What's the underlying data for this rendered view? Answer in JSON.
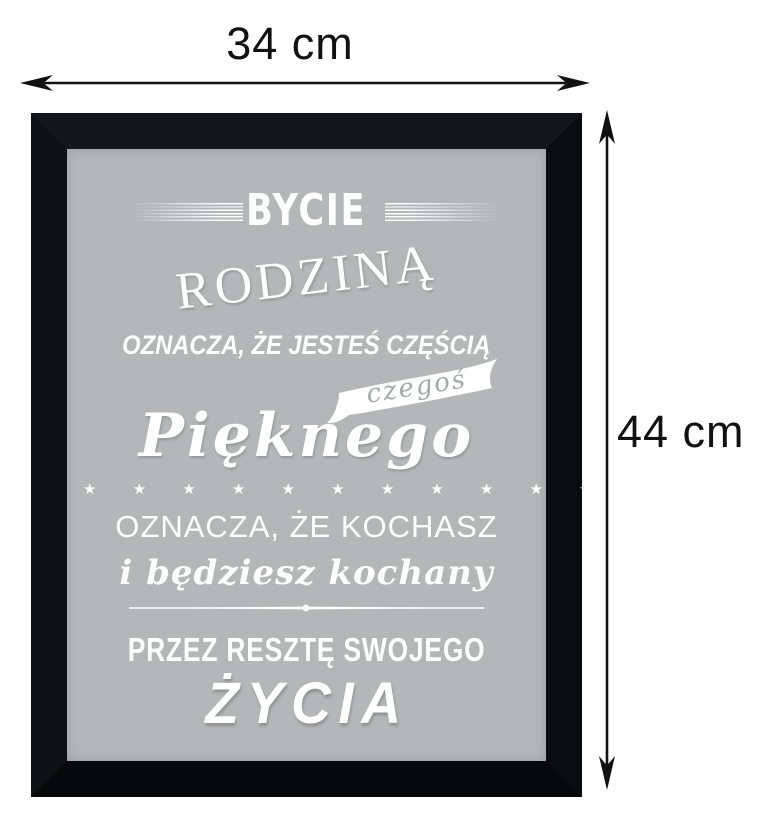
{
  "dimensions": {
    "width_label": "34 cm",
    "height_label": "44 cm"
  },
  "colors": {
    "frame": "#0c0e11",
    "poster_background": "#b4b6b8",
    "poster_text": "#ffffff",
    "ribbon_text": "#a6a9ab",
    "dimension_text": "#111111"
  },
  "poster": {
    "line_being": "BYCIE",
    "line_family": "RODZINĄ",
    "line_means_part": "OZNACZA, ŻE JESTEŚ CZĘŚCIĄ",
    "ribbon_word": "czegoś",
    "line_beautiful": "Pięknego",
    "stars": "★ ★ ★ ★ ★ ★ ★ ★ ★ ★ ★ ★",
    "star_count": 12,
    "line_means_love": "OZNACZA, ŻE KOCHASZ",
    "line_loved": "i będziesz kochany",
    "line_rest": "PRZEZ RESZTĘ SWOJEGO",
    "line_life": "ŻYCIA"
  }
}
